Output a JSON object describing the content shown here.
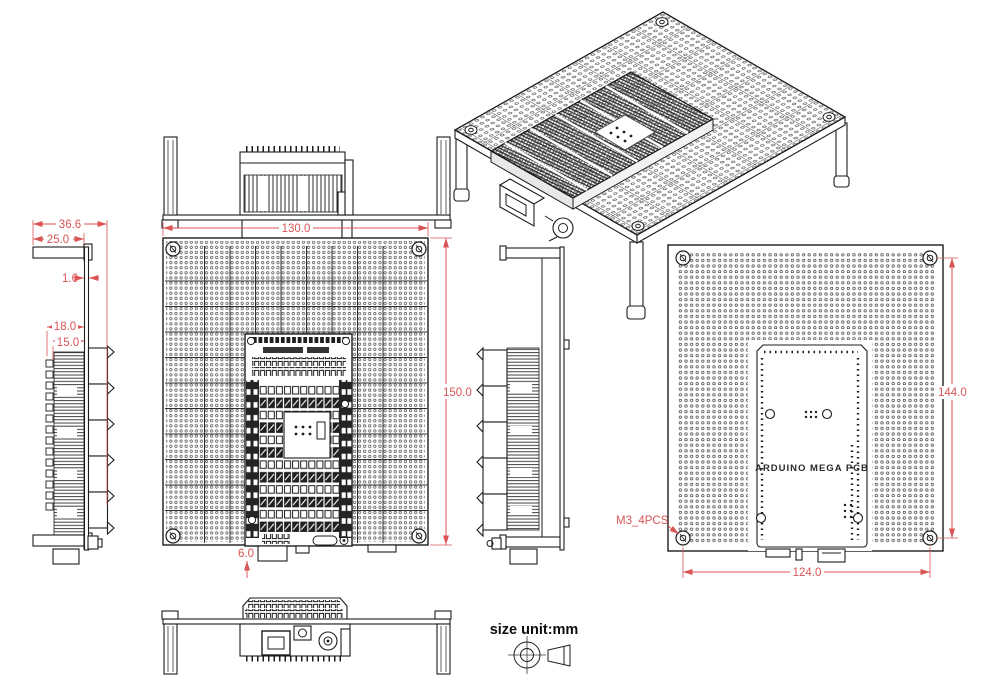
{
  "drawing": {
    "unit_note": "size unit:mm",
    "line_color": "#1c1c1c",
    "dim_color": "#d95454",
    "views": {
      "side_left": {
        "dims": {
          "total_depth": "36.6",
          "leg_length": "25.0",
          "plate_thickness": "1.6",
          "shield_depth": "18.0",
          "terminal_depth": "15.0"
        }
      },
      "top": {
        "dims": {
          "board_width": "130.0",
          "board_height": "150.0",
          "usb_offset": "6.0"
        }
      },
      "bottom": {
        "dims": {
          "mount_span_height": "144.0",
          "mount_span_width": "124.0"
        },
        "mount_note": "M3_4PCS",
        "silkscreen": "ARDUINO MEGA PCB"
      }
    }
  }
}
